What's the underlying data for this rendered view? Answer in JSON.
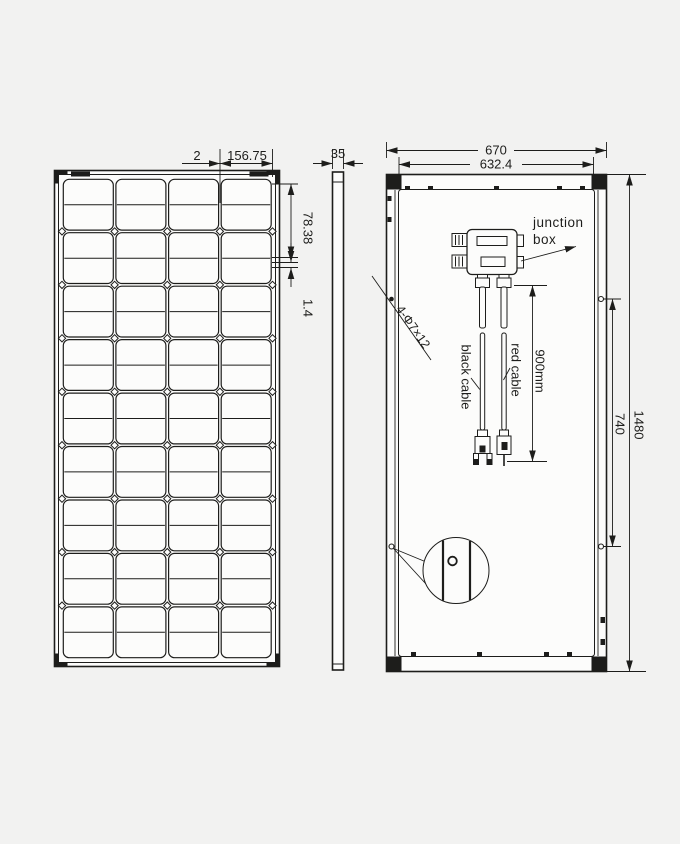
{
  "page": {
    "background": "#f2f2f1",
    "line_color": "#1d1d1b",
    "panel_fill": "#fcfcfb"
  },
  "front_view": {
    "columns": 4,
    "cell_groups": 9,
    "rows_per_group": 2,
    "dimensions": {
      "cell_gap_top": "2",
      "cell_width": "156.75",
      "cell_height": "78.38",
      "cell_gap_side": "1.4"
    }
  },
  "side_view": {
    "dimensions": {
      "thickness": "35"
    }
  },
  "back_view": {
    "dimensions": {
      "outer_width": "670",
      "inner_width": "632.4",
      "cable_length": "900mm",
      "mounting_hole_spacing": "740",
      "height": "1480",
      "mounting_holes": "4-Φ7×12"
    },
    "labels": {
      "junction_box_line1": "junction",
      "junction_box_line2": "box",
      "black_cable": "black cable",
      "red_cable": "red cable"
    }
  }
}
